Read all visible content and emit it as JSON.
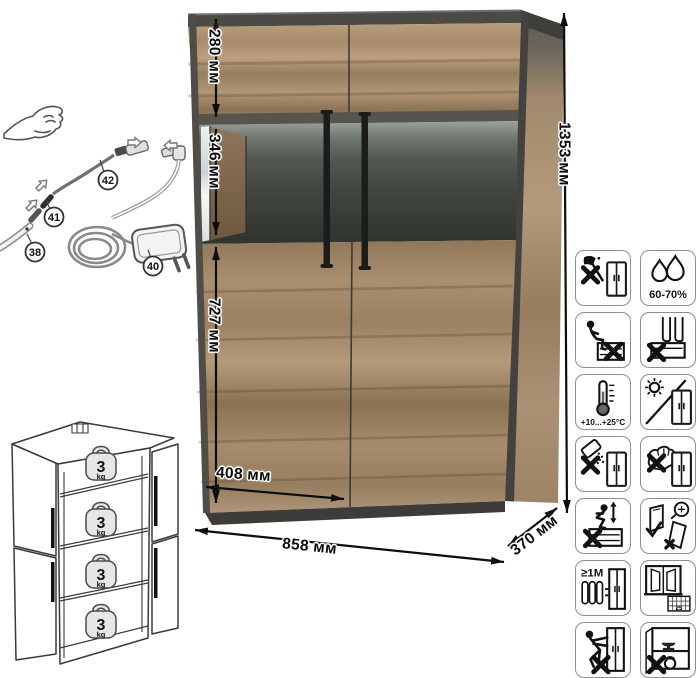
{
  "product_diagram": {
    "dimensions": {
      "total_height": "1353 мм",
      "total_width": "858 мм",
      "depth": "370 мм",
      "top_section_height": "280 мм",
      "glass_section_height": "346 мм",
      "lower_section_height": "727 мм",
      "door_width": "408 мм"
    },
    "lighting_kit": {
      "part_38": "38",
      "part_40": "40",
      "part_41": "41",
      "part_42": "42"
    },
    "shelf_load": {
      "weights": [
        {
          "value": "3",
          "unit": "kg"
        },
        {
          "value": "3",
          "unit": "kg"
        },
        {
          "value": "3",
          "unit": "kg"
        },
        {
          "value": "3",
          "unit": "kg"
        }
      ]
    },
    "care_icons": {
      "humidity_label": "60-70%",
      "temperature_label": "+10...+25°C",
      "min_distance_label": "≥1М",
      "calendar_label": "25",
      "names": [
        "no-sharp-tools",
        "humidity-60-70",
        "no-sitting",
        "no-standing-on-surfaces",
        "temperature-range",
        "avoid-direct-sunlight",
        "no-spilling-liquids",
        "no-abrasive-cleaning",
        "no-jumping",
        "anchor-to-wall",
        "keep-1m-from-heat",
        "ventilate-room",
        "no-pushing-dragging",
        "no-heavy-objects"
      ]
    },
    "colors": {
      "wood_light": "#b79c7c",
      "wood_mid": "#a18867",
      "wood_dark": "#8a7356",
      "frame_dark": "#4a4843",
      "glass_dark": "#3a3f3a",
      "handle_black": "#1d1d1b",
      "line_black": "#111111"
    }
  }
}
